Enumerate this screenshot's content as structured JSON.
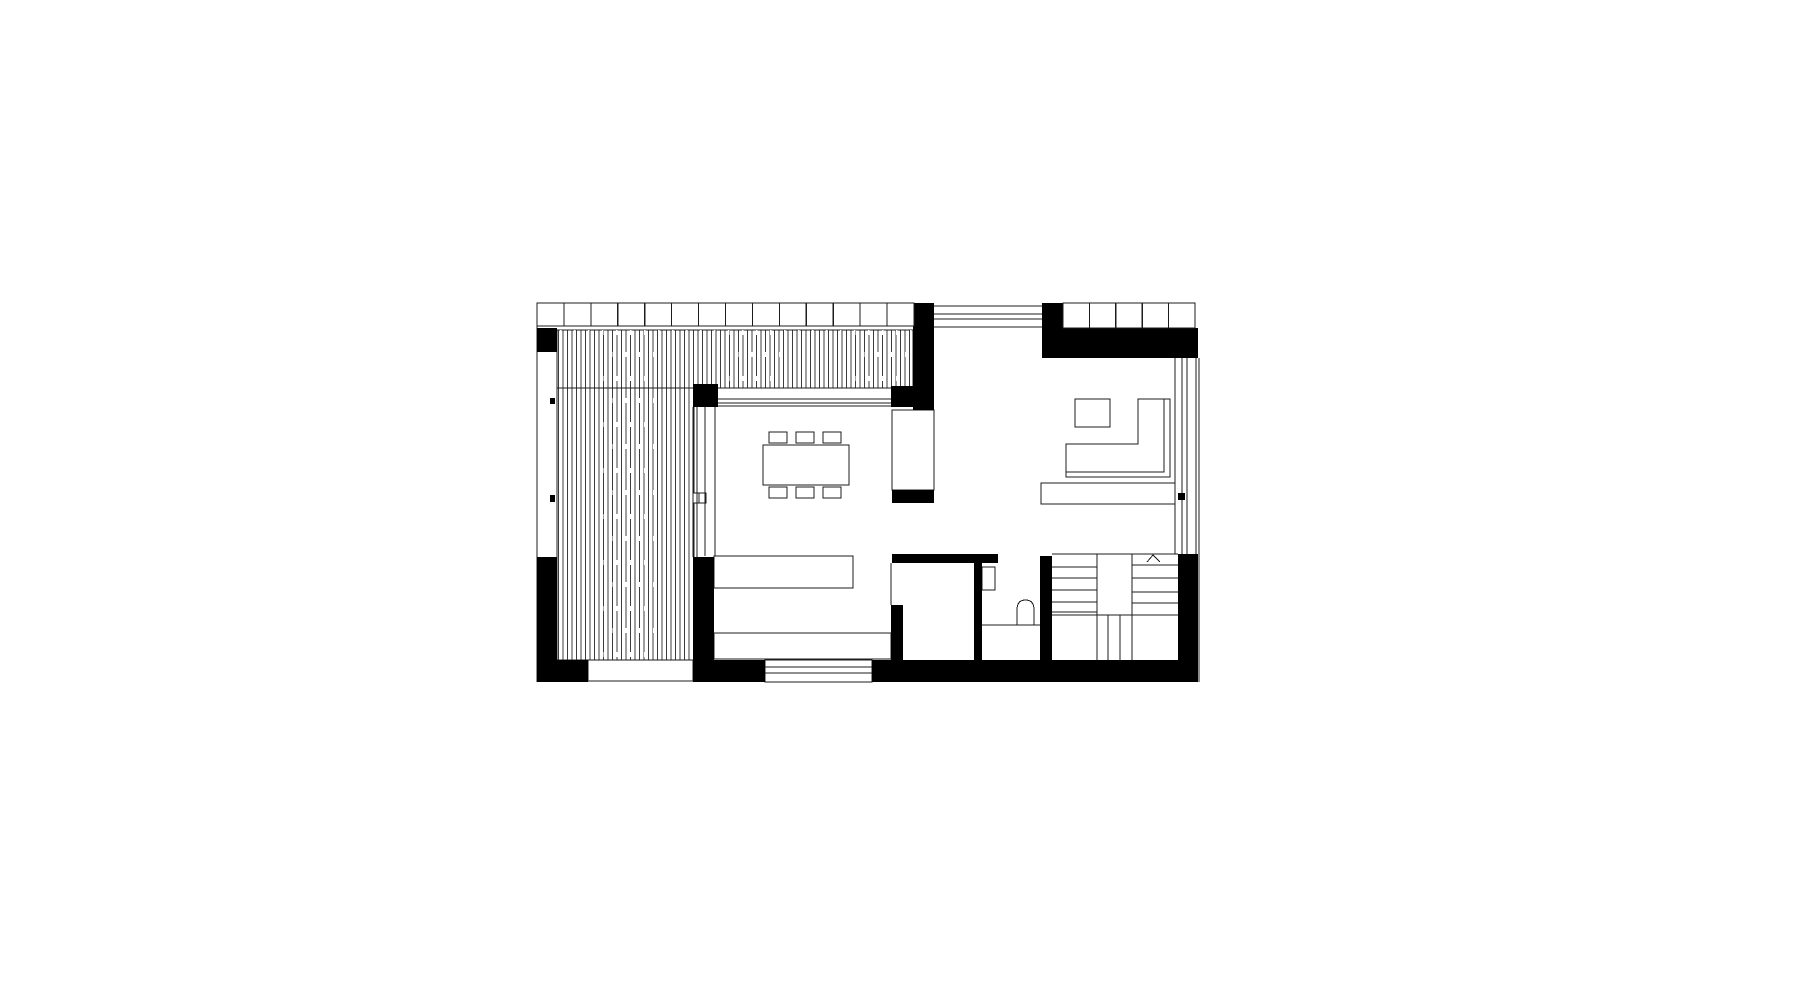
{
  "palette": {
    "background": "#ffffff",
    "wall_fill": "#000000",
    "line": "#1c1c1c",
    "deck_line": "#3c3c3c",
    "furniture_fill": "#ffffff"
  },
  "canvas": {
    "width": 1801,
    "height": 1001
  },
  "plan": {
    "walls": [
      {
        "name": "wall-top-left-block",
        "x": 537,
        "y": 328,
        "w": 20,
        "h": 24
      },
      {
        "name": "wall-left-lower",
        "x": 537,
        "y": 557,
        "w": 20,
        "h": 125
      },
      {
        "name": "wall-bottom-left-corner",
        "x": 537,
        "y": 660,
        "w": 51,
        "h": 22
      },
      {
        "name": "wall-terrace-dining-stub",
        "x": 693,
        "y": 384,
        "w": 25,
        "h": 23
      },
      {
        "name": "wall-kitchen-west",
        "x": 693,
        "y": 557,
        "w": 21,
        "h": 103
      },
      {
        "name": "wall-bottom-seg-west",
        "x": 693,
        "y": 660,
        "w": 72,
        "h": 22
      },
      {
        "name": "wall-bottom-seg-east",
        "x": 872,
        "y": 660,
        "w": 326,
        "h": 22
      },
      {
        "name": "wall-column-north",
        "x": 913,
        "y": 303,
        "w": 21,
        "h": 107
      },
      {
        "name": "wall-dining-stub-east",
        "x": 891,
        "y": 386,
        "w": 22,
        "h": 21
      },
      {
        "name": "wall-hall-stub",
        "x": 892,
        "y": 490,
        "w": 42,
        "h": 13
      },
      {
        "name": "wall-wc-north",
        "x": 892,
        "y": 554,
        "w": 106,
        "h": 9
      },
      {
        "name": "wall-kitchen-east-lower",
        "x": 891,
        "y": 605,
        "w": 12,
        "h": 55
      },
      {
        "name": "wall-wc-west",
        "x": 974,
        "y": 563,
        "w": 8,
        "h": 97
      },
      {
        "name": "wall-wc-east",
        "x": 1040,
        "y": 556,
        "w": 12,
        "h": 106
      },
      {
        "name": "wall-stair-east",
        "x": 1178,
        "y": 554,
        "w": 20,
        "h": 108
      },
      {
        "name": "wall-top-right-column",
        "x": 1042,
        "y": 303,
        "w": 21,
        "h": 25
      },
      {
        "name": "wall-top-right-band",
        "x": 1042,
        "y": 328,
        "w": 156,
        "h": 30
      },
      {
        "name": "window-mullion-tick-upper",
        "x": 550,
        "y": 398,
        "w": 5,
        "h": 6
      },
      {
        "name": "window-mullion-tick-lower",
        "x": 550,
        "y": 495,
        "w": 5,
        "h": 7
      },
      {
        "name": "wall-dot-east",
        "x": 1178,
        "y": 493,
        "w": 7,
        "h": 7
      }
    ],
    "deck_hatches": [
      {
        "name": "terrace-decking-north",
        "x": 557,
        "y": 330,
        "w": 356,
        "h": 58
      },
      {
        "name": "terrace-decking-west",
        "x": 557,
        "y": 388,
        "w": 137,
        "h": 272
      }
    ],
    "louver_rows": [
      {
        "name": "louver-roof-west",
        "x": 537,
        "y": 303,
        "w": 377,
        "h": 23,
        "cells": 14
      },
      {
        "name": "louver-roof-east",
        "x": 1063,
        "y": 303,
        "w": 132,
        "h": 25,
        "cells": 5
      }
    ],
    "furniture_rects": [
      {
        "name": "dining-table",
        "x": 763,
        "y": 445,
        "w": 86,
        "h": 40
      },
      {
        "name": "dining-chair",
        "x": 769,
        "y": 432,
        "w": 18,
        "h": 11
      },
      {
        "name": "dining-chair",
        "x": 796,
        "y": 432,
        "w": 18,
        "h": 11
      },
      {
        "name": "dining-chair",
        "x": 823,
        "y": 432,
        "w": 18,
        "h": 11
      },
      {
        "name": "dining-chair",
        "x": 769,
        "y": 487,
        "w": 18,
        "h": 11
      },
      {
        "name": "dining-chair",
        "x": 796,
        "y": 487,
        "w": 18,
        "h": 11
      },
      {
        "name": "dining-chair",
        "x": 823,
        "y": 487,
        "w": 18,
        "h": 11
      },
      {
        "name": "kitchen-island",
        "x": 714,
        "y": 556,
        "w": 139,
        "h": 32
      },
      {
        "name": "kitchen-counter",
        "x": 714,
        "y": 633,
        "w": 177,
        "h": 26
      },
      {
        "name": "tall-cabinet",
        "x": 892,
        "y": 410,
        "w": 42,
        "h": 80
      },
      {
        "name": "coffee-table",
        "x": 1075,
        "y": 399,
        "w": 35,
        "h": 28
      },
      {
        "name": "tv-sideboard",
        "x": 1041,
        "y": 483,
        "w": 134,
        "h": 21
      },
      {
        "name": "wc-sink",
        "x": 982,
        "y": 567,
        "w": 13,
        "h": 23
      },
      {
        "name": "terrace-step",
        "x": 588,
        "y": 660,
        "w": 105,
        "h": 21
      },
      {
        "name": "south-window",
        "x": 765,
        "y": 660,
        "w": 107,
        "h": 22
      },
      {
        "name": "door-handle-detail",
        "x": 693,
        "y": 493,
        "w": 13,
        "h": 10
      }
    ],
    "line_sets": [
      {
        "name": "plan-outline-left",
        "lines": [
          [
            537,
            303,
            537,
            682
          ]
        ]
      },
      {
        "name": "left-window-inner",
        "lines": [
          [
            557,
            352,
            557,
            557
          ]
        ]
      },
      {
        "name": "entry-glazing-north",
        "lines": [
          [
            933,
            306,
            1042,
            306
          ],
          [
            933,
            314,
            1042,
            314
          ],
          [
            933,
            319,
            1042,
            319
          ],
          [
            933,
            327,
            1042,
            327
          ]
        ]
      },
      {
        "name": "dining-glazing-north",
        "lines": [
          [
            718,
            388,
            891,
            388
          ],
          [
            718,
            399,
            891,
            399
          ],
          [
            718,
            403,
            891,
            403
          ],
          [
            718,
            406,
            891,
            406
          ]
        ]
      },
      {
        "name": "terrace-sliding-door",
        "lines": [
          [
            693,
            407,
            693,
            557
          ],
          [
            697,
            407,
            697,
            557
          ],
          [
            705,
            407,
            705,
            556
          ],
          [
            715,
            407,
            715,
            556
          ]
        ]
      },
      {
        "name": "east-glazing",
        "lines": [
          [
            1175,
            358,
            1175,
            554
          ],
          [
            1182,
            358,
            1182,
            554
          ],
          [
            1187,
            358,
            1187,
            554
          ],
          [
            1196,
            358,
            1196,
            662
          ],
          [
            1199,
            358,
            1199,
            682
          ]
        ]
      },
      {
        "name": "south-window-sill",
        "lines": [
          [
            765,
            667,
            872,
            667
          ],
          [
            765,
            673,
            872,
            673
          ]
        ]
      },
      {
        "name": "kitchen-east-opening",
        "lines": [
          [
            891,
            563,
            891,
            605
          ]
        ]
      },
      {
        "name": "wc-floor-line",
        "lines": [
          [
            982,
            625,
            1040,
            625
          ]
        ]
      },
      {
        "name": "stair-top-edge",
        "lines": [
          [
            1052,
            554,
            1178,
            554
          ]
        ]
      },
      {
        "name": "stair-treads-west",
        "lines": [
          [
            1052,
            567,
            1097,
            567
          ],
          [
            1052,
            578,
            1097,
            578
          ],
          [
            1052,
            590,
            1097,
            590
          ],
          [
            1052,
            602,
            1097,
            602
          ],
          [
            1052,
            612,
            1097,
            612
          ]
        ]
      },
      {
        "name": "stair-treads-east",
        "lines": [
          [
            1132,
            565,
            1178,
            565
          ],
          [
            1132,
            578,
            1178,
            578
          ],
          [
            1132,
            592,
            1178,
            592
          ],
          [
            1132,
            603,
            1178,
            603
          ]
        ]
      },
      {
        "name": "stair-well",
        "lines": [
          [
            1097,
            554,
            1097,
            615
          ],
          [
            1132,
            554,
            1132,
            615
          ],
          [
            1052,
            615,
            1178,
            615
          ]
        ]
      },
      {
        "name": "stair-balustrade",
        "lines": [
          [
            1097,
            615,
            1097,
            662
          ],
          [
            1108,
            615,
            1108,
            662
          ],
          [
            1120,
            615,
            1120,
            662
          ],
          [
            1132,
            615,
            1132,
            662
          ]
        ]
      },
      {
        "name": "door-handle-midline",
        "lines": [
          [
            699,
            493,
            699,
            503
          ]
        ]
      }
    ],
    "polylines": [
      {
        "name": "sofa-inner",
        "points": "1066,472 1066,444 1138,444 1138,399 1164,399 1164,472 1066,472"
      },
      {
        "name": "sofa-outer",
        "points": "1164,399 1170,399 1170,477 1066,477 1066,472"
      },
      {
        "name": "stair-direction-arrow",
        "points": "1147,562 1153,555 1160,562"
      }
    ],
    "paths": [
      {
        "name": "toilet",
        "d": "M 1017 625 L 1017 610 Q 1017 600 1025.5 600 Q 1034 600 1034 610 L 1034 625 Z"
      }
    ]
  }
}
